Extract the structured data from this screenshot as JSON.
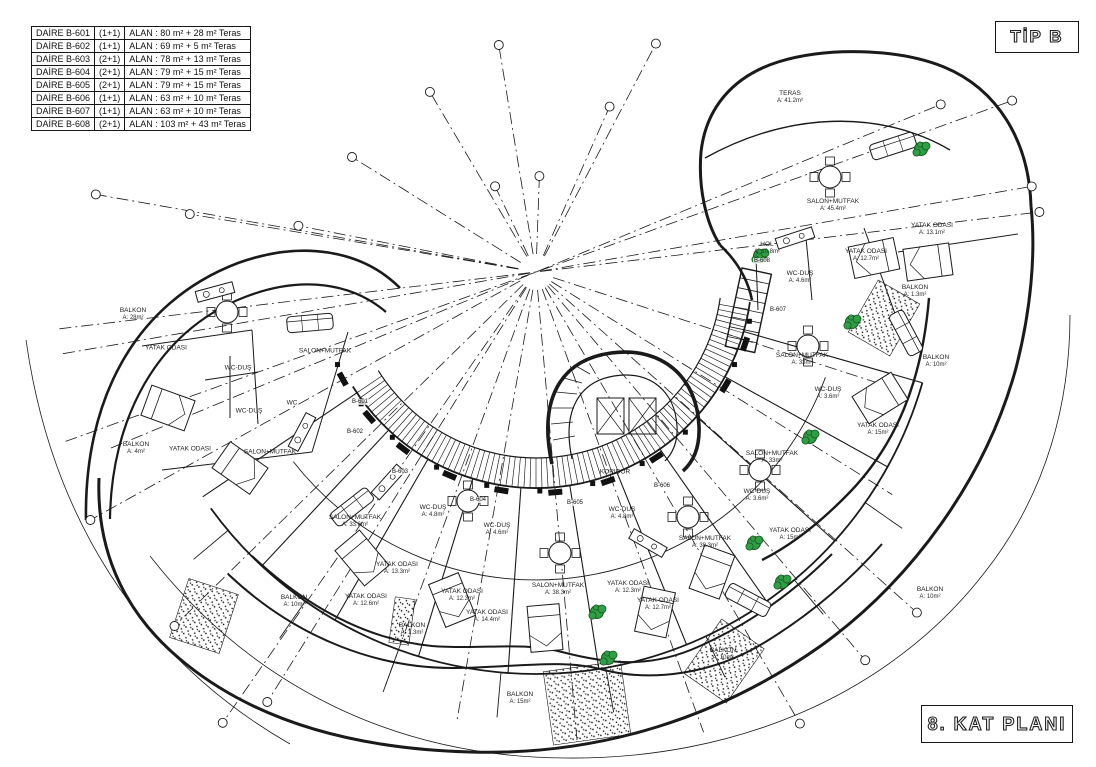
{
  "title_block": {
    "tip_label": "TİP B",
    "plan_label": "8. KAT PLANI"
  },
  "apartment_table": {
    "rows": [
      {
        "unit": "DAİRE B-601",
        "type": "(1+1)",
        "area": "ALAN :  80 m² + 28 m² Teras"
      },
      {
        "unit": "DAİRE B-602",
        "type": "(1+1)",
        "area": "ALAN :  69 m² +  5 m² Teras"
      },
      {
        "unit": "DAİRE B-603",
        "type": "(2+1)",
        "area": "ALAN :  78 m² + 13 m² Teras"
      },
      {
        "unit": "DAİRE B-604",
        "type": "(2+1)",
        "area": "ALAN :  79 m² + 15 m² Teras"
      },
      {
        "unit": "DAİRE B-605",
        "type": "(2+1)",
        "area": "ALAN :  79 m² + 15 m² Teras"
      },
      {
        "unit": "DAİRE B-606",
        "type": "(1+1)",
        "area": "ALAN :  63 m² + 10 m² Teras"
      },
      {
        "unit": "DAİRE B-607",
        "type": "(1+1)",
        "area": "ALAN :  63 m² + 10 m² Teras"
      },
      {
        "unit": "DAİRE B-608",
        "type": "(2+1)",
        "area": "ALAN : 103 m² + 43 m² Teras"
      }
    ]
  },
  "rooms": [
    {
      "label": "TERAS",
      "area": "A: 41.2m²",
      "x": 790,
      "y": 98
    },
    {
      "label": "SALON+MUTFAK",
      "area": "A: 45.4m²",
      "x": 833,
      "y": 206
    },
    {
      "label": "YATAK ODASI",
      "area": "A: 13.1m²",
      "x": 932,
      "y": 230
    },
    {
      "label": "YATAK ODASI",
      "area": "A: 12.7m²",
      "x": 866,
      "y": 256
    },
    {
      "label": "HOL",
      "area": "A: 10.8m²",
      "x": 767,
      "y": 249
    },
    {
      "label": "WC-DUŞ",
      "area": "A: 4.6m²",
      "x": 800,
      "y": 278
    },
    {
      "label": "BALKON",
      "area": "A: 1.3m²",
      "x": 915,
      "y": 292
    },
    {
      "label": "SALON+MUTFAK",
      "area": "A: 33m²",
      "x": 802,
      "y": 360
    },
    {
      "label": "BALKON",
      "area": "A: 10m²",
      "x": 936,
      "y": 362
    },
    {
      "label": "WC-DUŞ",
      "area": "A: 3.6m²",
      "x": 828,
      "y": 394
    },
    {
      "label": "YATAK ODASI",
      "area": "A: 15m²",
      "x": 878,
      "y": 430
    },
    {
      "label": "SALON+MUTFAK",
      "area": "A: 33m²",
      "x": 772,
      "y": 458
    },
    {
      "label": "WC-DUŞ",
      "area": "A: 3.6m²",
      "x": 757,
      "y": 496
    },
    {
      "label": "YATAK ODASI",
      "area": "A: 15m²",
      "x": 790,
      "y": 535
    },
    {
      "label": "BALKON",
      "area": "A: 10m²",
      "x": 930,
      "y": 594
    },
    {
      "label": "BALKON",
      "area": "A: 10m²",
      "x": 723,
      "y": 655
    },
    {
      "label": "SALON+MUTFAK",
      "area": "A: 38.3m²",
      "x": 705,
      "y": 543
    },
    {
      "label": "YATAK ODASI",
      "area": "A: 12.7m²",
      "x": 658,
      "y": 605
    },
    {
      "label": "YATAK ODASI",
      "area": "A: 12.3m²",
      "x": 628,
      "y": 588
    },
    {
      "label": "SALON+MUTFAK",
      "area": "A: 38.3m²",
      "x": 558,
      "y": 590
    },
    {
      "label": "WC-DUŞ",
      "area": "A: 4.8m²",
      "x": 622,
      "y": 514
    },
    {
      "label": "YATAK ODASI",
      "area": "A: 14.4m²",
      "x": 487,
      "y": 617
    },
    {
      "label": "YATAK ODASI",
      "area": "A: 12.3m²",
      "x": 462,
      "y": 596
    },
    {
      "label": "BALKON",
      "area": "A: 15m²",
      "x": 520,
      "y": 699
    },
    {
      "label": "WC-DUŞ",
      "area": "A: 4.8m²",
      "x": 433,
      "y": 512
    },
    {
      "label": "WC-DUŞ",
      "area": "A: 4.6m²",
      "x": 497,
      "y": 530
    },
    {
      "label": "SALON+MUTFAK",
      "area": "A: 33.6m²",
      "x": 355,
      "y": 522
    },
    {
      "label": "YATAK ODASI",
      "area": "A: 13.3m²",
      "x": 397,
      "y": 569
    },
    {
      "label": "YATAK ODASI",
      "area": "A: 12.6m²",
      "x": 366,
      "y": 601
    },
    {
      "label": "BALKON",
      "area": "A: 1.3m²",
      "x": 412,
      "y": 630
    },
    {
      "label": "BALKON",
      "area": "A: 10m²",
      "x": 294,
      "y": 602
    },
    {
      "label": "KORIDOR",
      "area": "",
      "x": 615,
      "y": 473
    },
    {
      "label": "BALKON",
      "area": "A: 28m²",
      "x": 133,
      "y": 315
    },
    {
      "label": "YATAK ODASI",
      "area": "",
      "x": 166,
      "y": 349
    },
    {
      "label": "WC-DUŞ",
      "area": "",
      "x": 238,
      "y": 369
    },
    {
      "label": "SALON+MUTFAK",
      "area": "",
      "x": 325,
      "y": 352
    },
    {
      "label": "WC-DUŞ",
      "area": "",
      "x": 249,
      "y": 412
    },
    {
      "label": "WC",
      "area": "",
      "x": 292,
      "y": 404
    },
    {
      "label": "SALON+MUTFAK",
      "area": "",
      "x": 270,
      "y": 453
    },
    {
      "label": "YATAK ODASI",
      "area": "",
      "x": 190,
      "y": 450
    },
    {
      "label": "BALKON",
      "area": "A: 4m²",
      "x": 136,
      "y": 449
    }
  ],
  "unit_tags": [
    {
      "label": "B-601",
      "x": 360,
      "y": 402
    },
    {
      "label": "B-602",
      "x": 355,
      "y": 432
    },
    {
      "label": "B-603",
      "x": 400,
      "y": 472
    },
    {
      "label": "B-604",
      "x": 478,
      "y": 500
    },
    {
      "label": "B-605",
      "x": 575,
      "y": 503
    },
    {
      "label": "B-606",
      "x": 662,
      "y": 486
    },
    {
      "label": "B-607",
      "x": 778,
      "y": 310
    },
    {
      "label": "B-608",
      "x": 762,
      "y": 261
    }
  ],
  "plants": [
    {
      "x": 921,
      "y": 149
    },
    {
      "x": 760,
      "y": 256
    },
    {
      "x": 852,
      "y": 322
    },
    {
      "x": 810,
      "y": 437
    },
    {
      "x": 754,
      "y": 543
    },
    {
      "x": 782,
      "y": 582
    },
    {
      "x": 597,
      "y": 612
    },
    {
      "x": 608,
      "y": 658
    }
  ],
  "colors": {
    "line": "#1a1a1a",
    "plant": "#2f9e44",
    "plant_dark": "#14591f"
  }
}
